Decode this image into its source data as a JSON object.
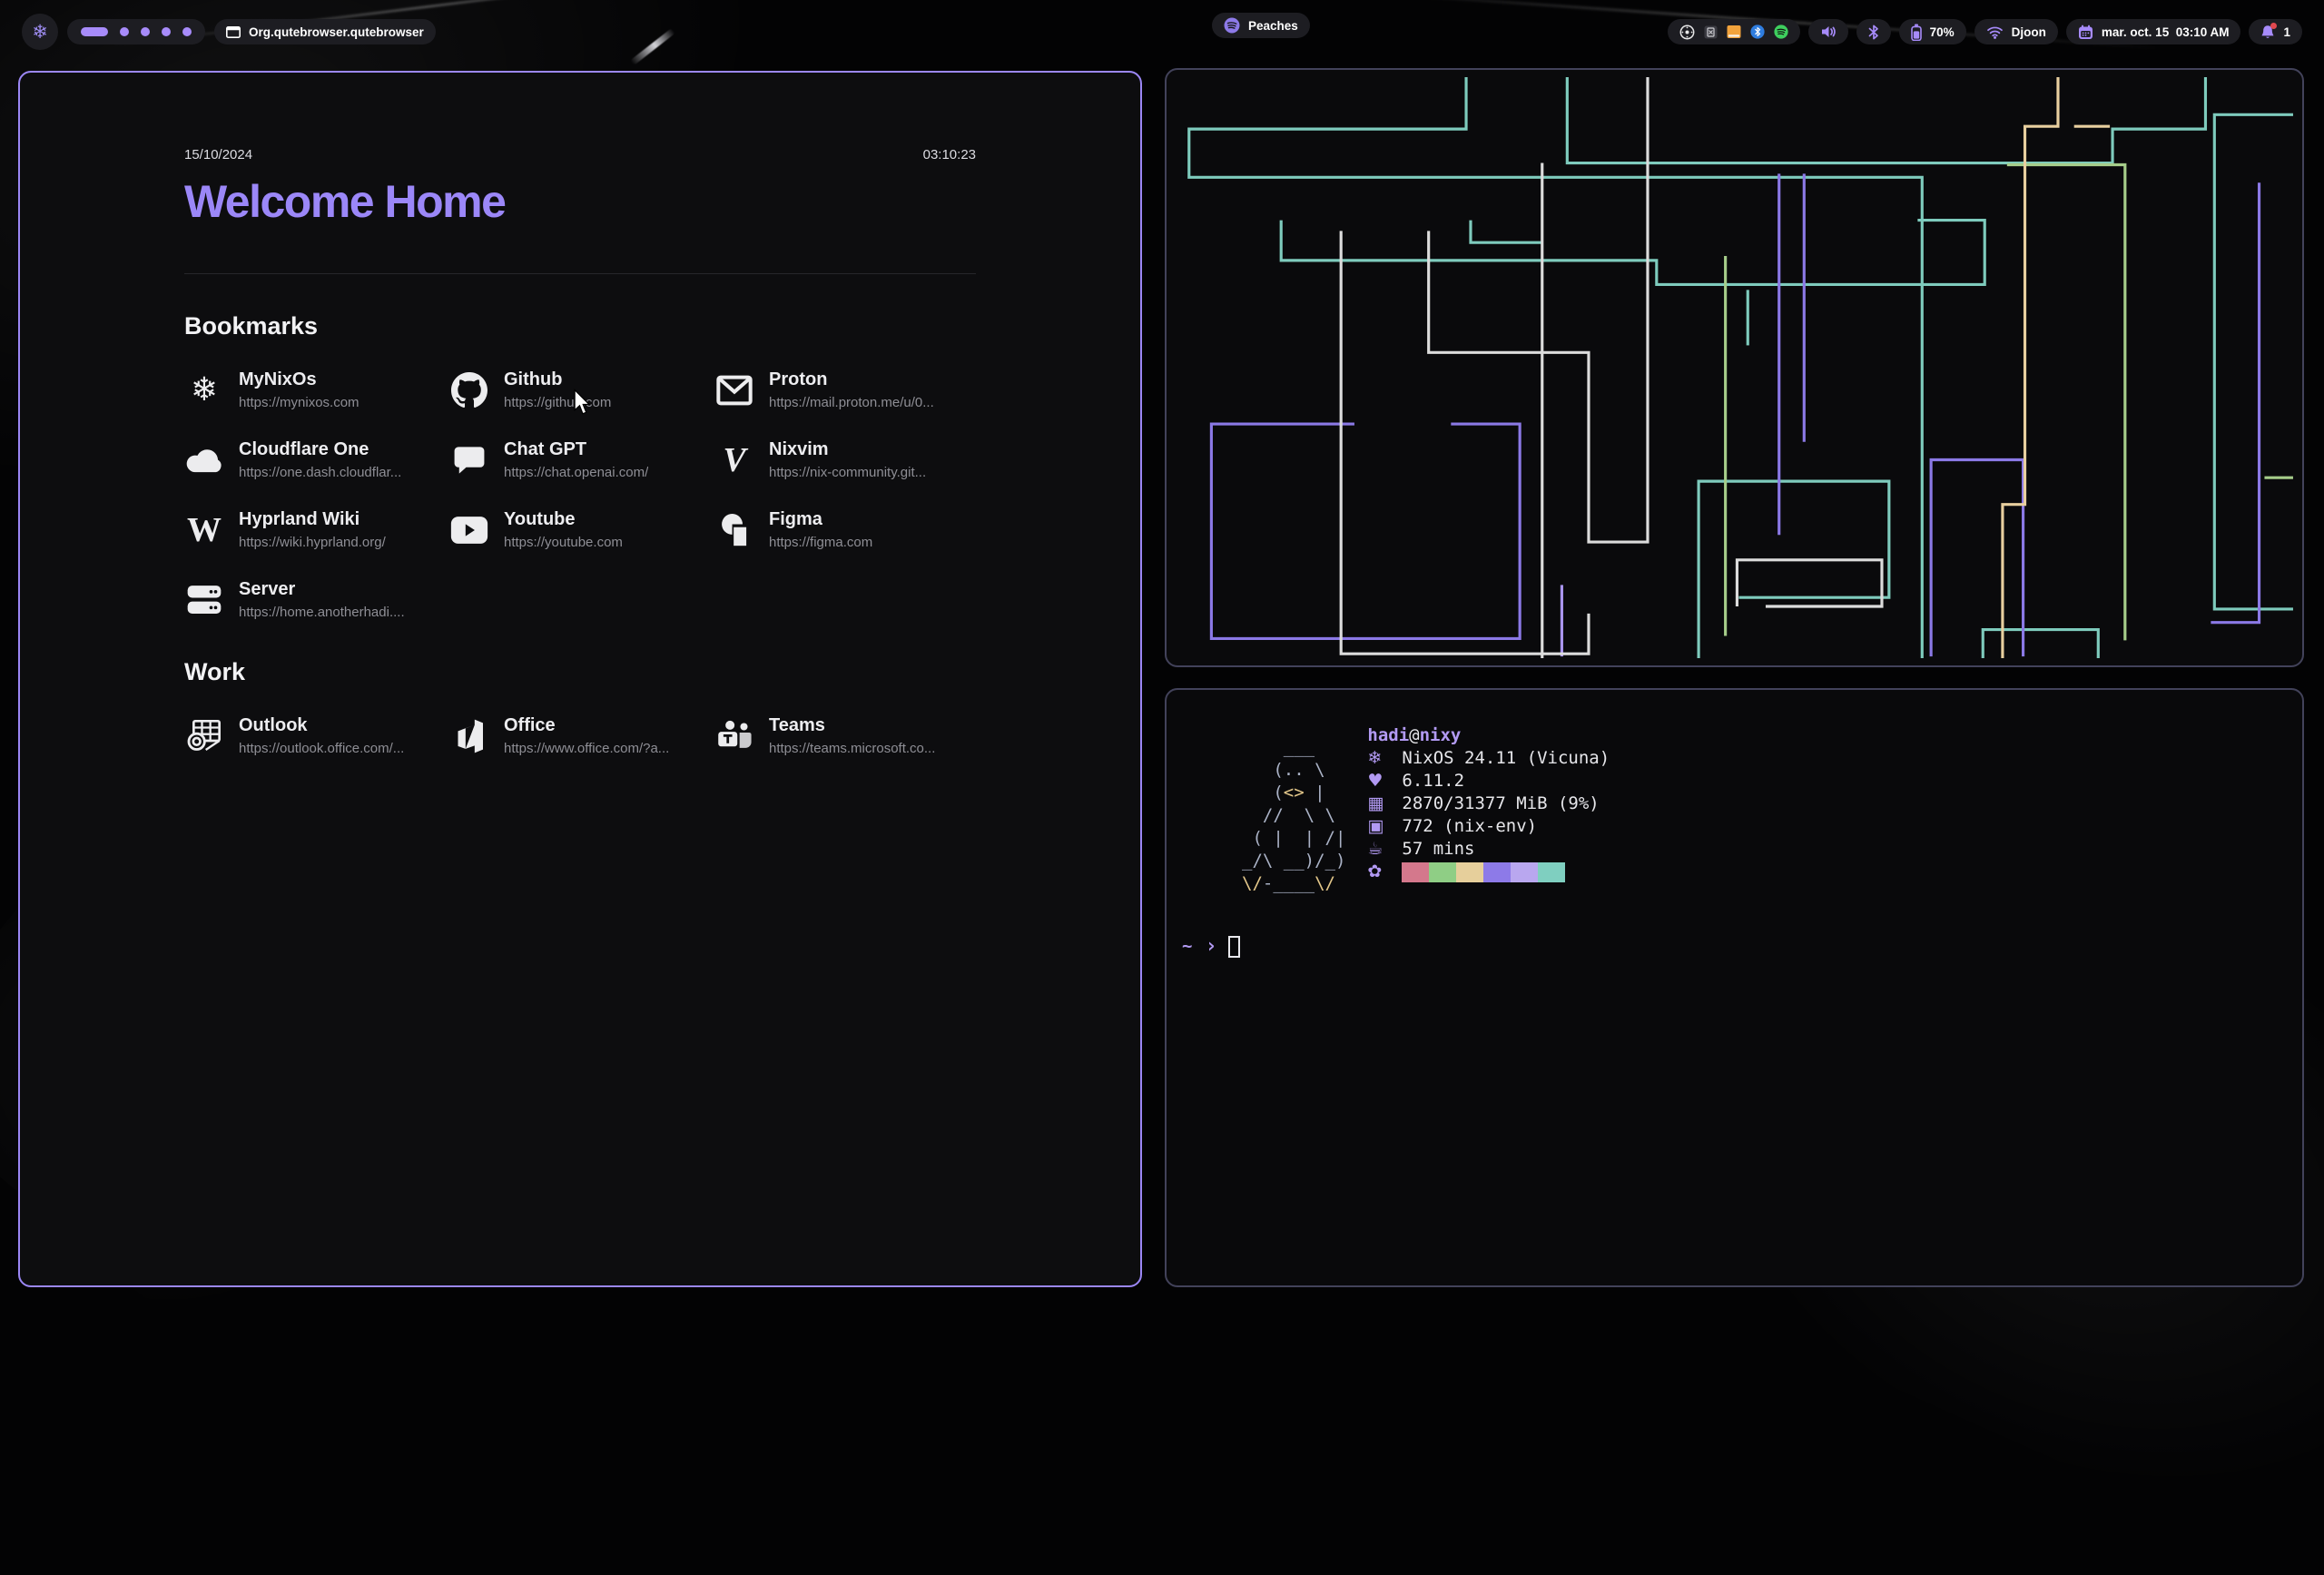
{
  "topbar": {
    "launcher_icon": "nix-snowflake",
    "workspaces": {
      "count": 5,
      "active_index": 0
    },
    "window_title": "Org.qutebrowser.qutebrowser",
    "media_label": "Peaches",
    "tray": [
      "record",
      "keepass",
      "files",
      "bluetooth",
      "spotify"
    ],
    "battery_label": "70%",
    "network_label": "Djoon",
    "clock_label": "mar. oct. 15  03:10 AM",
    "notification_count": "1"
  },
  "startpage": {
    "date": "15/10/2024",
    "time": "03:10:23",
    "title": "Welcome Home",
    "sections": [
      {
        "heading": "Bookmarks",
        "links": [
          {
            "name": "MyNixOs",
            "url": "https://mynixos.com",
            "icon": "mynixos"
          },
          {
            "name": "Github",
            "url": "https://github.com",
            "icon": "github"
          },
          {
            "name": "Proton",
            "url": "https://mail.proton.me/u/0...",
            "icon": "proton"
          },
          {
            "name": "Cloudflare One",
            "url": "https://one.dash.cloudflar...",
            "icon": "cloudflare"
          },
          {
            "name": "Chat GPT",
            "url": "https://chat.openai.com/",
            "icon": "chatgpt"
          },
          {
            "name": "Nixvim",
            "url": "https://nix-community.git...",
            "icon": "nixvim"
          },
          {
            "name": "Hyprland Wiki",
            "url": "https://wiki.hyprland.org/",
            "icon": "wiki"
          },
          {
            "name": "Youtube",
            "url": "https://youtube.com",
            "icon": "youtube"
          },
          {
            "name": "Figma",
            "url": "https://figma.com",
            "icon": "figma"
          },
          {
            "name": "Server",
            "url": "https://home.anotherhadi....",
            "icon": "server"
          }
        ]
      },
      {
        "heading": "Work",
        "links": [
          {
            "name": "Outlook",
            "url": "https://outlook.office.com/...",
            "icon": "outlook"
          },
          {
            "name": "Office",
            "url": "https://www.office.com/?a...",
            "icon": "office"
          },
          {
            "name": "Teams",
            "url": "https://teams.microsoft.co...",
            "icon": "teams"
          }
        ]
      }
    ]
  },
  "pipes": {
    "palette": {
      "teal": "#7ecbbd",
      "purple": "#8b79e6",
      "lilac": "#a995ee",
      "white": "#dcdcdc",
      "green": "#a6cd8a",
      "tan": "#e8cf9f"
    },
    "paths": [
      {
        "c": "teal",
        "p": [
          [
            325,
            0
          ],
          [
            325,
            58
          ],
          [
            15,
            58
          ],
          [
            15,
            112
          ],
          [
            835,
            112
          ],
          [
            835,
            650
          ]
        ]
      },
      {
        "c": "teal",
        "p": [
          [
            438,
            0
          ],
          [
            438,
            96
          ],
          [
            1048,
            96
          ],
          [
            1048,
            58
          ],
          [
            1152,
            58
          ],
          [
            1152,
            0
          ]
        ]
      },
      {
        "c": "teal",
        "p": [
          [
            1250,
            42
          ],
          [
            1162,
            42
          ],
          [
            1162,
            595
          ],
          [
            1250,
            595
          ]
        ]
      },
      {
        "c": "teal",
        "p": [
          [
            118,
            160
          ],
          [
            118,
            205
          ],
          [
            538,
            205
          ],
          [
            538,
            232
          ],
          [
            905,
            232
          ],
          [
            905,
            160
          ],
          [
            830,
            160
          ]
        ]
      },
      {
        "c": "teal",
        "p": [
          [
            585,
            650
          ],
          [
            585,
            452
          ],
          [
            798,
            452
          ],
          [
            798,
            582
          ],
          [
            630,
            582
          ]
        ]
      },
      {
        "c": "teal",
        "p": [
          [
            903,
            650
          ],
          [
            903,
            618
          ],
          [
            1032,
            618
          ],
          [
            1032,
            650
          ]
        ]
      },
      {
        "c": "teal",
        "p": [
          [
            640,
            238
          ],
          [
            640,
            300
          ]
        ]
      },
      {
        "c": "teal",
        "p": [
          [
            330,
            160
          ],
          [
            330,
            185
          ],
          [
            410,
            185
          ]
        ]
      },
      {
        "c": "purple",
        "p": [
          [
            200,
            388
          ],
          [
            40,
            388
          ],
          [
            40,
            628
          ],
          [
            385,
            628
          ],
          [
            385,
            388
          ],
          [
            308,
            388
          ]
        ]
      },
      {
        "c": "purple",
        "p": [
          [
            675,
            108
          ],
          [
            675,
            512
          ]
        ]
      },
      {
        "c": "purple",
        "p": [
          [
            703,
            108
          ],
          [
            703,
            408
          ]
        ]
      },
      {
        "c": "purple",
        "p": [
          [
            845,
            648
          ],
          [
            845,
            428
          ],
          [
            948,
            428
          ],
          [
            948,
            648
          ]
        ]
      },
      {
        "c": "purple",
        "p": [
          [
            1212,
            118
          ],
          [
            1212,
            610
          ],
          [
            1158,
            610
          ]
        ]
      },
      {
        "c": "lilac",
        "p": [
          [
            432,
            568
          ],
          [
            432,
            648
          ]
        ]
      },
      {
        "c": "white",
        "p": [
          [
            185,
            172
          ],
          [
            185,
            645
          ],
          [
            462,
            645
          ],
          [
            462,
            600
          ]
        ]
      },
      {
        "c": "white",
        "p": [
          [
            283,
            172
          ],
          [
            283,
            308
          ],
          [
            462,
            308
          ],
          [
            462,
            520
          ],
          [
            528,
            520
          ],
          [
            528,
            0
          ]
        ]
      },
      {
        "c": "white",
        "p": [
          [
            410,
            96
          ],
          [
            410,
            650
          ]
        ]
      },
      {
        "c": "white",
        "p": [
          [
            628,
            592
          ],
          [
            628,
            540
          ],
          [
            790,
            540
          ],
          [
            790,
            592
          ],
          [
            660,
            592
          ]
        ]
      },
      {
        "c": "green",
        "p": [
          [
            615,
            200
          ],
          [
            615,
            625
          ]
        ]
      },
      {
        "c": "green",
        "p": [
          [
            930,
            98
          ],
          [
            1062,
            98
          ],
          [
            1062,
            630
          ]
        ]
      },
      {
        "c": "green",
        "p": [
          [
            1250,
            448
          ],
          [
            1218,
            448
          ]
        ]
      },
      {
        "c": "tan",
        "p": [
          [
            987,
            0
          ],
          [
            987,
            55
          ],
          [
            950,
            55
          ],
          [
            950,
            478
          ],
          [
            925,
            478
          ],
          [
            925,
            650
          ]
        ]
      },
      {
        "c": "tan",
        "p": [
          [
            1005,
            55
          ],
          [
            1045,
            55
          ]
        ]
      }
    ]
  },
  "fetch": {
    "user": "hadi",
    "at": "@",
    "host": "nixy",
    "ascii": [
      "    ___",
      "   (.. \\",
      "   (<> |",
      "  //  \\ \\",
      " ( |  | /|",
      "_/\\ __)/_)",
      "\\/-____\\/"
    ],
    "rows": [
      {
        "icon": "distro-snowflake",
        "glyph": "❄",
        "text": "NixOS 24.11 (Vicuna)"
      },
      {
        "icon": "kernel",
        "glyph": "♥",
        "text": "6.11.2"
      },
      {
        "icon": "memory",
        "glyph": "▦",
        "text": "2870/31377 MiB (9%)"
      },
      {
        "icon": "packages",
        "glyph": "▣",
        "text": "772 (nix-env)"
      },
      {
        "icon": "uptime",
        "glyph": "☕",
        "text": "57 mins"
      }
    ],
    "palette_icon_glyph": "✿",
    "palette": [
      "#d4788c",
      "#8fce85",
      "#e6cf9b",
      "#8d7ae8",
      "#b9a7ef",
      "#7fcfc0"
    ],
    "prompt_cwd": "~",
    "prompt_symbol": "›"
  },
  "colors": {
    "accent": "#9b87f5",
    "topbar_icon": "#a78bfa",
    "window_border_right": "#42425a",
    "notification_dot": "#e0484f"
  }
}
